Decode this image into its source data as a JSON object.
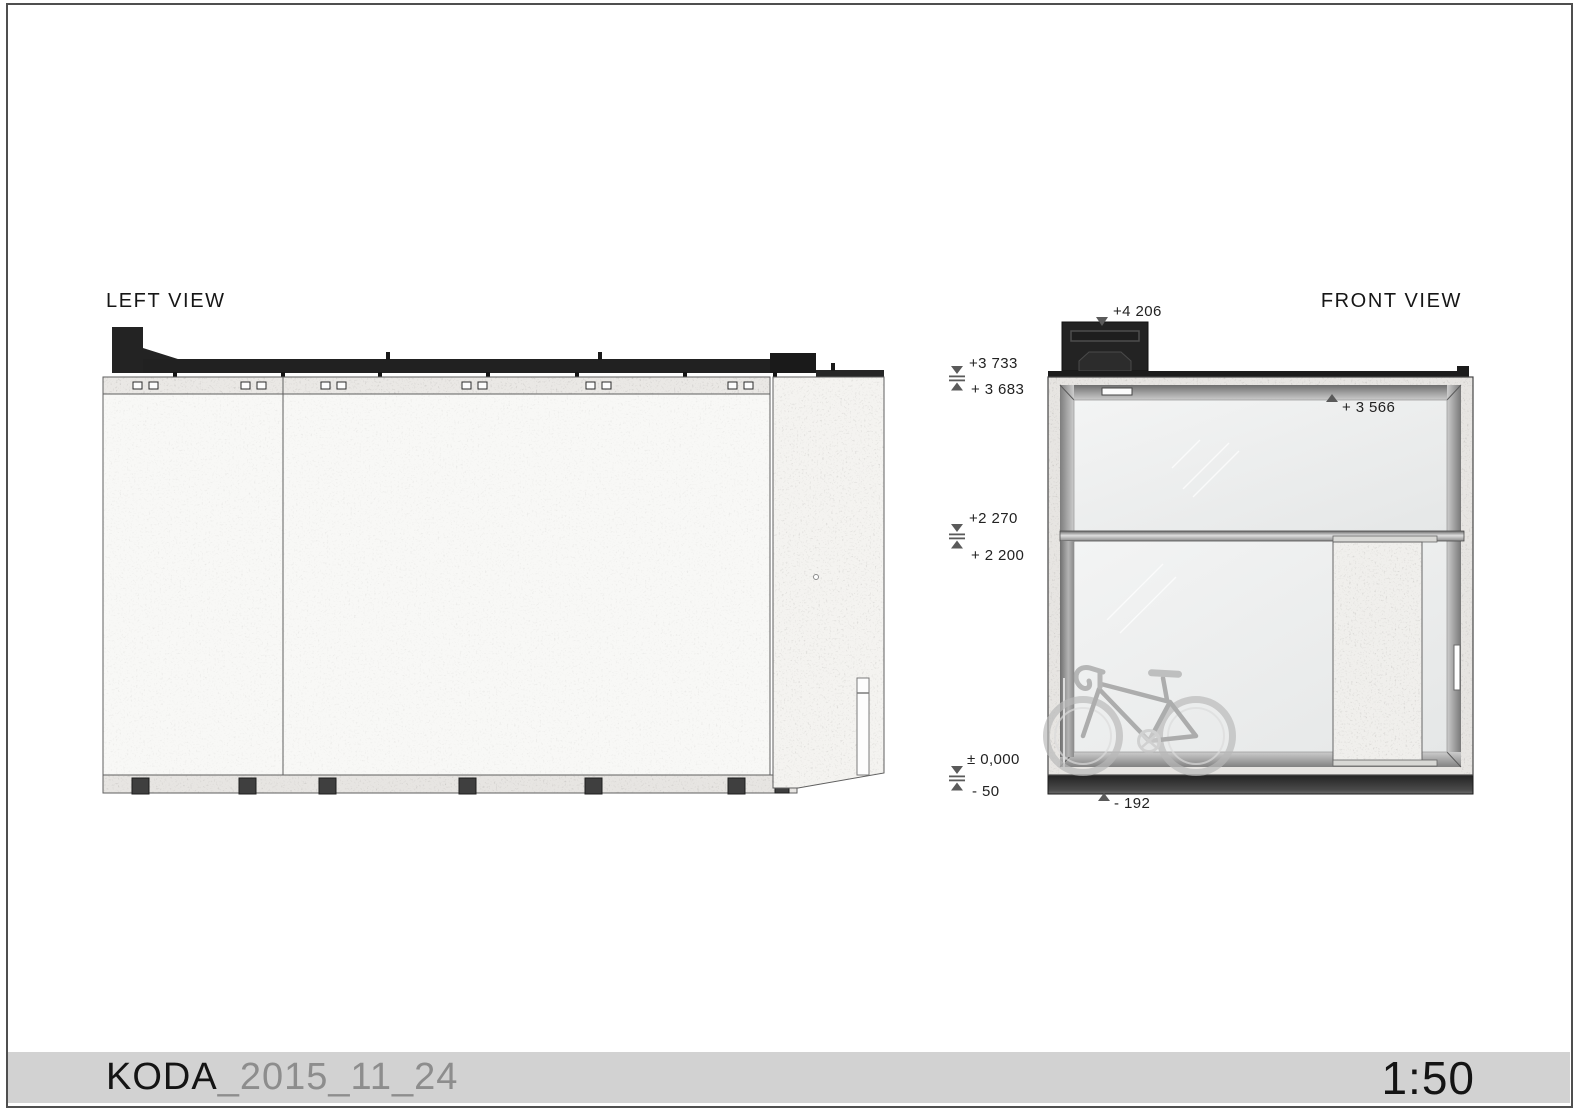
{
  "footer": {
    "project": "KODA",
    "revision": "_2015_11_24",
    "scale": "1:50"
  },
  "left_view": {
    "title": "LEFT VIEW"
  },
  "front_view": {
    "title": "FRONT VIEW",
    "levels": {
      "chimney_top": "+4 206",
      "roof_top": "+3 733",
      "roof_underside": "+ 3 683",
      "glazing_top": "+ 3 566",
      "ceiling_top": "+2 270",
      "ceiling_bottom": "+ 2 200",
      "floor_zero": "± 0,000",
      "floor_minus_50": "- 50",
      "foundation_bottom": "- 192"
    }
  }
}
